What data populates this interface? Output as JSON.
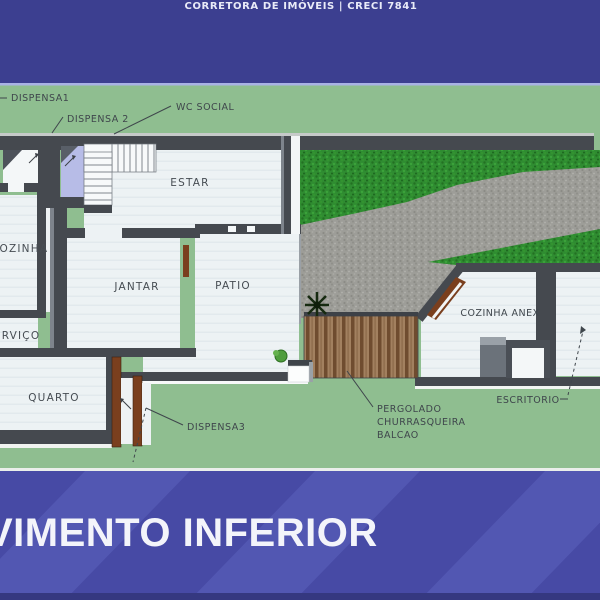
{
  "header": {
    "brokerage": "CORRETORA DE IMÓVEIS | CRECI 7841"
  },
  "footer": {
    "title": "VIMENTO INFERIOR"
  },
  "plan": {
    "rooms": {
      "estar": "ESTAR",
      "cozinha": "COZINHA",
      "servico": "SERVIÇO",
      "jantar": "JANTAR",
      "patio": "PATIO",
      "quarto": "QUARTO",
      "cozinha_anexa": "COZINHA ANEX",
      "escritorio": "ESCRITORIO"
    },
    "callouts": {
      "dispensa1": "DISPENSA1",
      "dispensa2": "DISPENSA 2",
      "wc_social": "WC SOCIAL",
      "dispensa3": "DISPENSA3",
      "pergolado": [
        "PERGOLADO",
        "CHURRASQUEIRA",
        "BALCAO"
      ]
    }
  },
  "colors": {
    "top_banner": "#3c3f90",
    "bottom_banner": "#474aa5",
    "banner_highlight": "#a9b2e4",
    "background_green": "#8fbe90",
    "grass": "#2f8c31",
    "driveway": "#9d9d98",
    "wall": "#45494f",
    "floor": "#edf2f4",
    "dispensa2_floor": "#b7bce7",
    "wood_door": "#7a3f1e",
    "label_text": "#3f464c",
    "banner_text": "#ffffff"
  }
}
